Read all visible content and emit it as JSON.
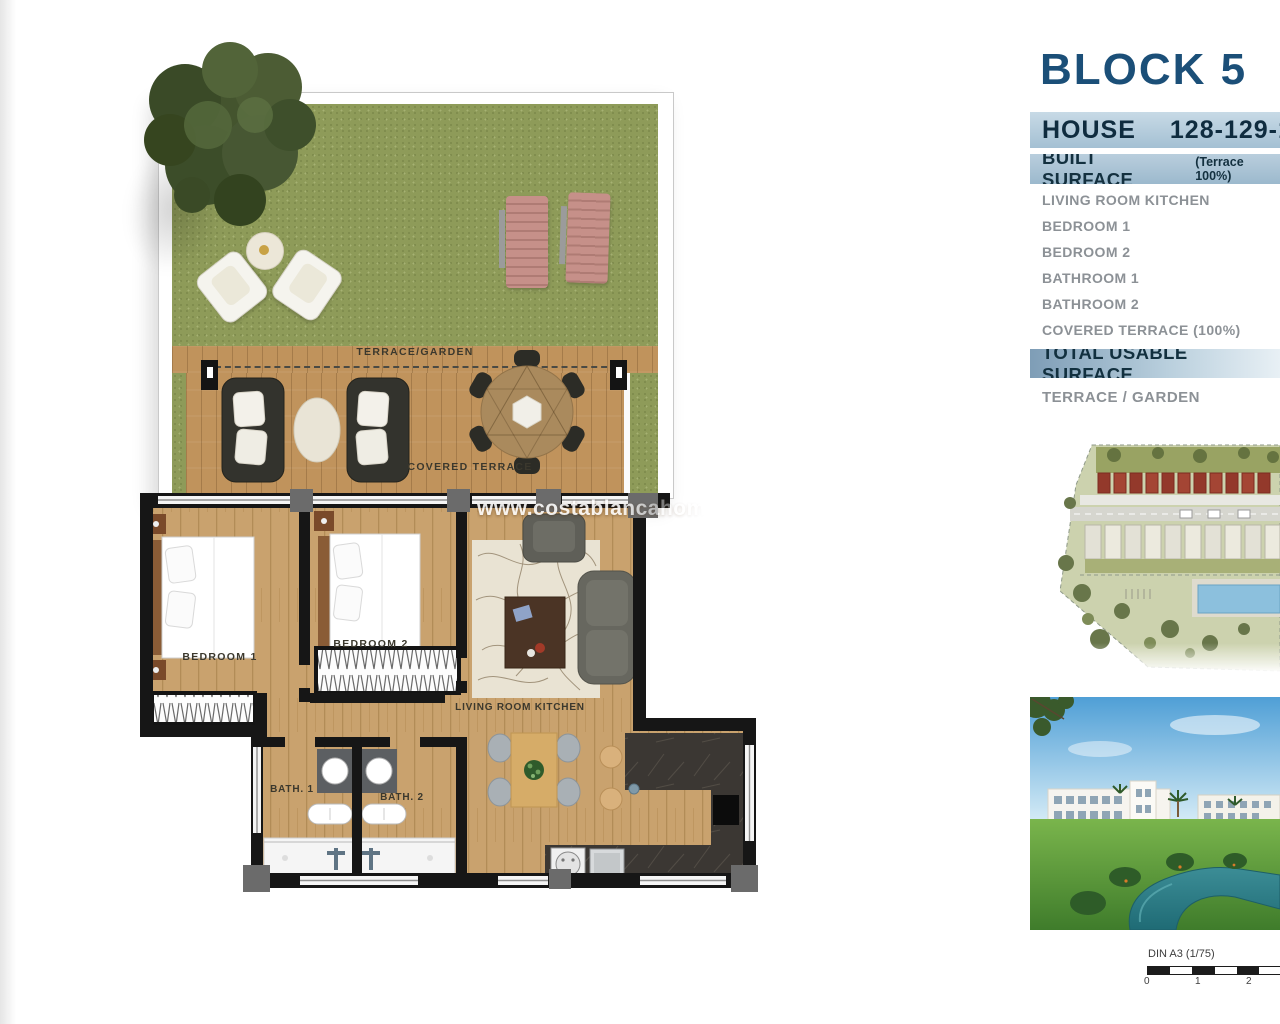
{
  "floor_plan": {
    "watermark": "www.costablancahom",
    "labels": {
      "terrace_garden": "TERRACE/GARDEN",
      "covered_terrace": "COVERED TERRACE",
      "bedroom_1": "BEDROOM 1",
      "bedroom_2": "BEDROOM 2",
      "living_room": "LIVING ROOM KITCHEN",
      "bath_1": "BATH. 1",
      "bath_2": "BATH. 2"
    }
  },
  "info_panel": {
    "block_title": "BLOCK 5",
    "house_row": {
      "label": "HOUSE",
      "numbers": "128-129-13"
    },
    "built_surface": {
      "label": "BUILT SURFACE",
      "note": "(Terrace 100%)"
    },
    "rooms": [
      "LIVING ROOM KITCHEN",
      "BEDROOM 1",
      "BEDROOM 2",
      "BATHROOM 1",
      "BATHROOM 2",
      "COVERED TERRACE (100%)"
    ],
    "total_label": "TOTAL USABLE SURFACE",
    "terrace_garden_label": "TERRACE / GARDEN",
    "colors": {
      "accent_navy": "#1b4f78",
      "bar_text_navy": "#12303f",
      "bar_bg_light": "#c8dae6",
      "bar_bg_dark": "#7e9db6",
      "list_text_gray": "#8c9196"
    }
  },
  "scale_bar": {
    "label": "DIN A3 (1/75)",
    "ticks": [
      "0",
      "1",
      "2"
    ]
  }
}
